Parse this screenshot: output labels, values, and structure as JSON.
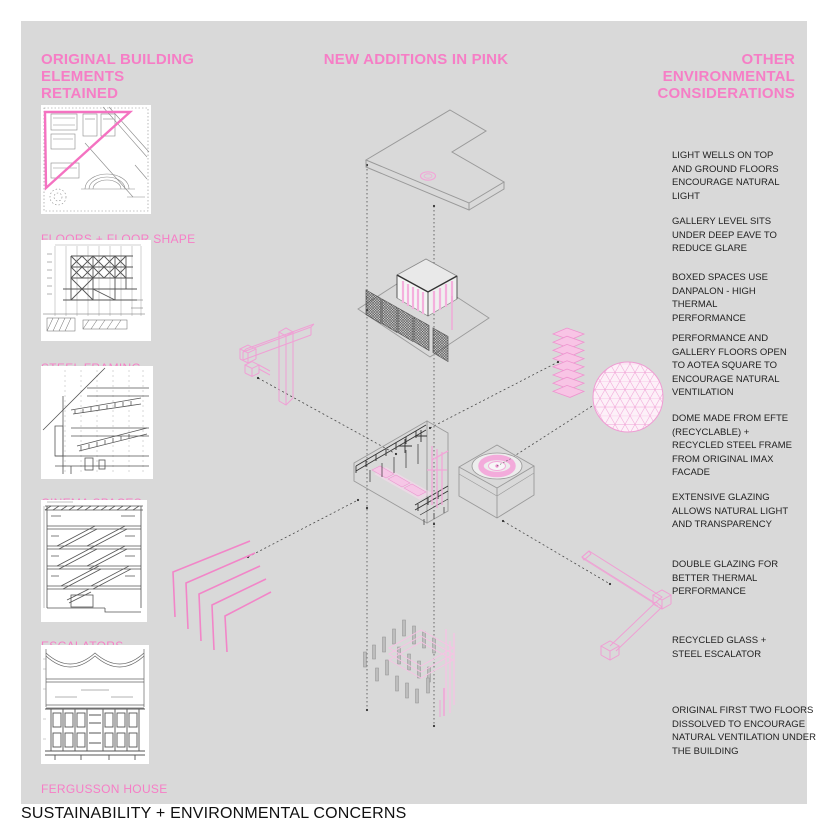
{
  "page": {
    "footer_title": "SUSTAINABILITY + ENVIRONMENTAL CONCERNS",
    "colors": {
      "accent_pink": "#f67ec6",
      "panel_gray": "#d9d9d9",
      "text_black": "#222222"
    }
  },
  "left_column": {
    "header": "ORIGINAL BUILDING ELEMENTS RETAINED",
    "items": [
      {
        "label": "FLOORS + FLOOR SHAPE"
      },
      {
        "label": "STEEL FRAMING"
      },
      {
        "label": "CINEMA SPACES"
      },
      {
        "label": "ESCALATORS"
      },
      {
        "label": "FERGUSSON HOUSE"
      }
    ]
  },
  "center": {
    "header": "NEW ADDITIONS IN PINK"
  },
  "right_column": {
    "header": "OTHER ENVIRONMENTAL CONSIDERATIONS",
    "notes": [
      "LIGHT WELLS ON TOP AND GROUND FLOORS ENCOURAGE NATURAL LIGHT",
      "GALLERY LEVEL SITS UNDER DEEP EAVE TO REDUCE GLARE",
      "BOXED SPACES USE DANPALON - HIGH THERMAL PERFORMANCE",
      "PERFORMANCE AND GALLERY FLOORS OPEN TO AOTEA SQUARE TO ENCOURAGE NATURAL VENTILATION",
      "DOME MADE FROM EFTE (RECYCLABLE) + RECYCLED STEEL FRAME FROM ORIGINAL IMAX FACADE",
      "EXTENSIVE GLAZING ALLOWS NATURAL LIGHT AND TRANSPARENCY",
      "DOUBLE GLAZING FOR BETTER THERMAL PERFORMANCE",
      "RECYCLED GLASS + STEEL ESCALATOR",
      "ORIGINAL FIRST TWO FLOORS DISSOLVED TO ENCOURAGE NATURAL VENTILATION UNDER THE BUILDING"
    ]
  }
}
